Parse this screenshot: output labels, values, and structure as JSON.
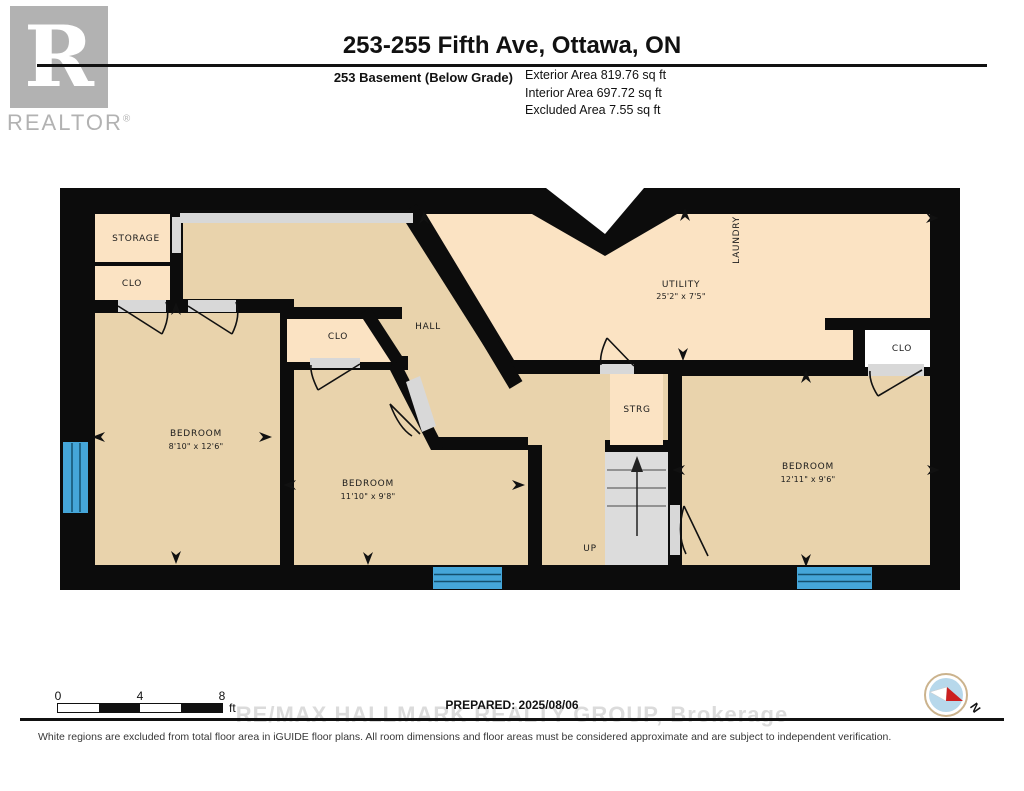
{
  "header": {
    "logo": {
      "letter": "R",
      "wordmark": "REALTOR",
      "registered": "®"
    },
    "title": "253-255 Fifth Ave, Ottawa, ON",
    "floor_label": "253 Basement (Below Grade)",
    "areas": [
      "Exterior Area 819.76 sq ft",
      "Interior Area 697.72 sq ft",
      "Excluded Area 7.55 sq ft"
    ]
  },
  "rooms": {
    "storage": {
      "label": "STORAGE"
    },
    "clo_left": {
      "label": "CLO"
    },
    "clo_middle": {
      "label": "CLO"
    },
    "clo_right": {
      "label": "CLO"
    },
    "hall": {
      "label": "HALL"
    },
    "laundry": {
      "label": "LAUNDRY"
    },
    "utility": {
      "label": "UTILITY",
      "dims": "25'2\" x 7'5\""
    },
    "strg": {
      "label": "STRG"
    },
    "stairs": {
      "label": "UP"
    },
    "bedroom_left": {
      "label": "BEDROOM",
      "dims": "8'10\" x 12'6\""
    },
    "bedroom_middle": {
      "label": "BEDROOM",
      "dims": "11'10\" x 9'8\""
    },
    "bedroom_right": {
      "label": "BEDROOM",
      "dims": "12'11\" x 9'6\""
    }
  },
  "scalebar": {
    "ticks": [
      "0",
      "4",
      "8"
    ],
    "unit": "ft"
  },
  "footer": {
    "prepared": "PREPARED: 2025/08/06",
    "watermark": "RE/MAX HALLMARK REALTY GROUP, Brokerage",
    "disclaimer": "White regions are excluded from total floor area in iGUIDE floor plans. All room dimensions and floor areas must be considered approximate and are subject to independent verification."
  },
  "compass": {
    "label": "N"
  },
  "icons": {
    "direction-arrow": "▲",
    "compass-needle": "red-white pointer",
    "realtor-logo": "gray block R"
  },
  "colors": {
    "wall_black": "#0c0c0c",
    "room_light": "#fbe3c3",
    "room_tan": "#e9d3ac",
    "opening_gray": "#d8d8d8",
    "stairs_gray": "#dcdcdc",
    "window_blue": "#45a6d9",
    "excluded_white": "#ffffff",
    "compass_ring": "#cbb38d",
    "compass_fill": "#b7d8eb",
    "needle_red": "#cc1f1f",
    "watermark_gray": "#dbdbdb",
    "logo_gray": "#b2b2b2"
  }
}
